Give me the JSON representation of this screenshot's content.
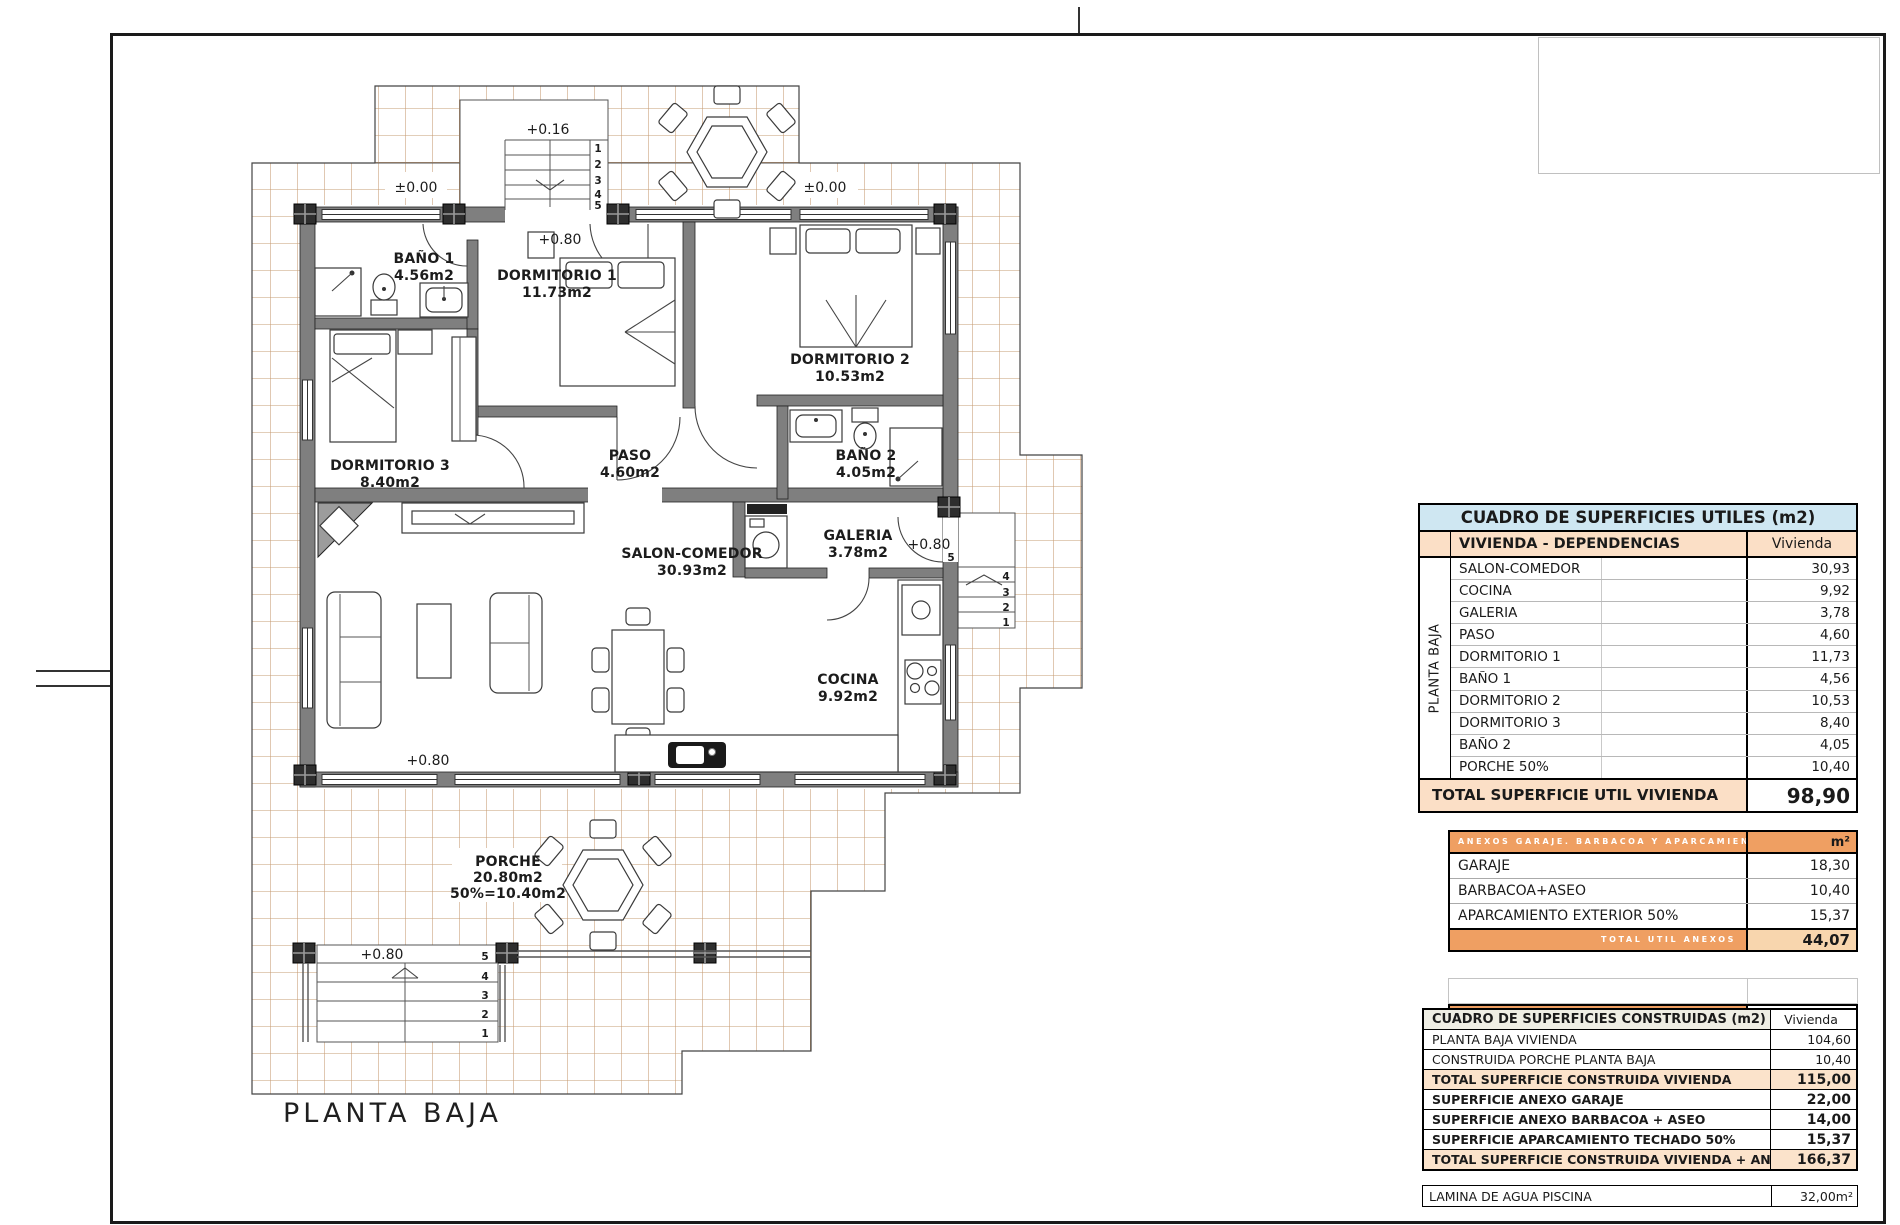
{
  "sheet": {
    "plan_title": "PLANTA BAJA"
  },
  "colors": {
    "header_blue": "#cfe7f2",
    "peach": "#fbdfc6",
    "orange": "#ef9f62",
    "tile_line": "#c69c73",
    "wall_gray": "#7f7f7f"
  },
  "plan": {
    "rooms": [
      {
        "name": "BAÑO 1",
        "area": "4.56m2"
      },
      {
        "name": "DORMITORIO 1",
        "area": "11.73m2"
      },
      {
        "name": "DORMITORIO 2",
        "area": "10.53m2"
      },
      {
        "name": "DORMITORIO 3",
        "area": "8.40m2"
      },
      {
        "name": "PASO",
        "area": "4.60m2"
      },
      {
        "name": "BAÑO 2",
        "area": "4.05m2"
      },
      {
        "name": "SALON-COMEDOR",
        "area": "30.93m2"
      },
      {
        "name": "GALERIA",
        "area": "3.78m2"
      },
      {
        "name": "COCINA",
        "area": "9.92m2"
      },
      {
        "name": "PORCHE",
        "area": "20.80m2",
        "note": "50%=10.40m2"
      }
    ],
    "levels": {
      "zero": "±0.00",
      "plus016": "+0.16",
      "plus080": "+0.80"
    },
    "stairs": {
      "n1": "1",
      "n2": "2",
      "n3": "3",
      "n4": "4",
      "n5": "5"
    }
  },
  "tables": {
    "utiles": {
      "title": "CUADRO DE SUPERFICIES UTILES (m2)",
      "group": "VIVIENDA - DEPENDENCIAS",
      "col": "Vivienda",
      "side": "PLANTA BAJA",
      "rows": [
        {
          "label": "SALON-COMEDOR",
          "value": "30,93"
        },
        {
          "label": "COCINA",
          "value": "9,92"
        },
        {
          "label": "GALERIA",
          "value": "3,78"
        },
        {
          "label": "PASO",
          "value": "4,60"
        },
        {
          "label": "DORMITORIO 1",
          "value": "11,73"
        },
        {
          "label": "BAÑO 1",
          "value": "4,56"
        },
        {
          "label": "DORMITORIO 2",
          "value": "10,53"
        },
        {
          "label": "DORMITORIO 3",
          "value": "8,40"
        },
        {
          "label": "BAÑO 2",
          "value": "4,05"
        },
        {
          "label": "PORCHE 50%",
          "value": "10,40"
        }
      ],
      "total_label": "TOTAL SUPERFICIE UTIL VIVIENDA",
      "total_value": "98,90"
    },
    "anexos": {
      "header": "ANEXOS GARAJE. BARBACOA Y APARCAMIENTO",
      "unit": "m²",
      "rows": [
        {
          "label": "GARAJE",
          "value": "18,30"
        },
        {
          "label": "BARBACOA+ASEO",
          "value": "10,40"
        },
        {
          "label": "APARCAMIENTO EXTERIOR 50%",
          "value": "15,37"
        }
      ],
      "total_label": "TOTAL UTIL ANEXOS",
      "total_value": "44,07"
    },
    "piscina": {
      "label": "LAMINA DE AGUA- PISCINA",
      "value": "32,00"
    },
    "construidas": {
      "title": "CUADRO DE SUPERFICIES CONSTRUIDAS (m2)",
      "col": "Vivienda",
      "rows": [
        {
          "label": "PLANTA BAJA VIVIENDA",
          "value": "104,60"
        },
        {
          "label": "CONSTRUIDA PORCHE PLANTA BAJA",
          "value": "10,40"
        },
        {
          "label": "TOTAL SUPERFICIE CONSTRUIDA VIVIENDA",
          "value": "115,00"
        },
        {
          "label": "SUPERFICIE ANEXO GARAJE",
          "value": "22,00"
        },
        {
          "label": "SUPERFICIE ANEXO BARBACOA + ASEO",
          "value": "14,00"
        },
        {
          "label": "SUPERFICIE APARCAMIENTO TECHADO 50%",
          "value": "15,37"
        },
        {
          "label": "TOTAL SUPERFICIE CONSTRUIDA VIVIENDA + ANEXOS",
          "value": "166,37"
        }
      ]
    },
    "lamina": {
      "label": "LAMINA DE AGUA PISCINA",
      "value": "32,00m²"
    }
  }
}
